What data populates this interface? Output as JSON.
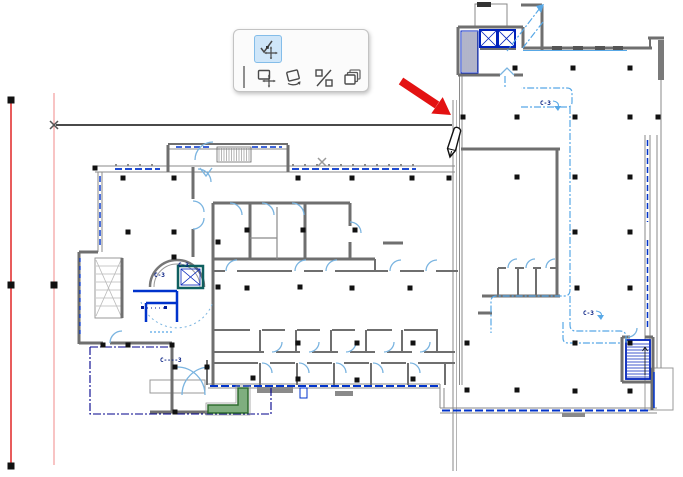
{
  "palette": {
    "tools": [
      {
        "id": "move-sub-element",
        "icon": "check-move-icon",
        "selected": true
      },
      {
        "id": "drag",
        "icon": "drag-move-icon",
        "selected": false
      },
      {
        "id": "rotate",
        "icon": "rotate-icon",
        "selected": false
      },
      {
        "id": "mirror",
        "icon": "mirror-icon",
        "selected": false
      },
      {
        "id": "multiply",
        "icon": "multiply-icon",
        "selected": false
      }
    ]
  },
  "plan": {
    "labels": [
      {
        "id": "route-tag-top",
        "text": "C-3"
      },
      {
        "id": "route-tag-lower",
        "text": "C-3"
      },
      {
        "id": "elevator-tag",
        "text": "C-3"
      },
      {
        "id": "stair-tag",
        "text": "C-3"
      },
      {
        "id": "zone-tag-bottom-left",
        "text": "C----3"
      }
    ]
  },
  "colors": {
    "wall_gray": "#6f6f6f",
    "window_blue": "#0033cc",
    "door_swing_blue": "#7ab4e0",
    "escape_route_blue": "#58a8e6",
    "zone_boundary_navy": "#00008b",
    "reference_red": "#e85c5c",
    "annotation_arrow_red": "#e31212",
    "selection_fill": "#cfe6f9",
    "planter_green": "#7fae7f"
  }
}
